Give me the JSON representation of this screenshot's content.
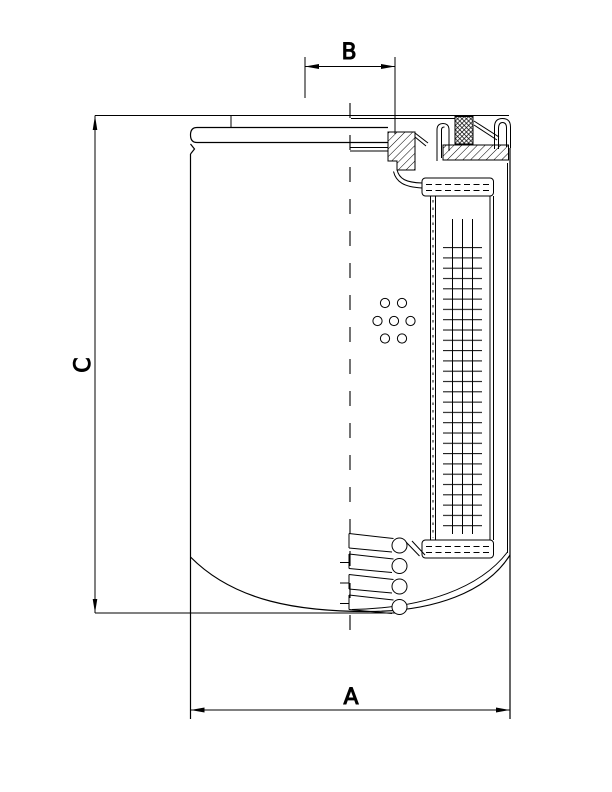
{
  "page": {
    "background_color": "#ffffff",
    "line_color": "#000000"
  },
  "drawing": {
    "kind": "technical-cross-section-drawing",
    "subject": "spin-on filter cartridge, half-sectioned side view",
    "dimensions": {
      "a_label": "A",
      "b_label": "B",
      "c_label": "C"
    }
  }
}
